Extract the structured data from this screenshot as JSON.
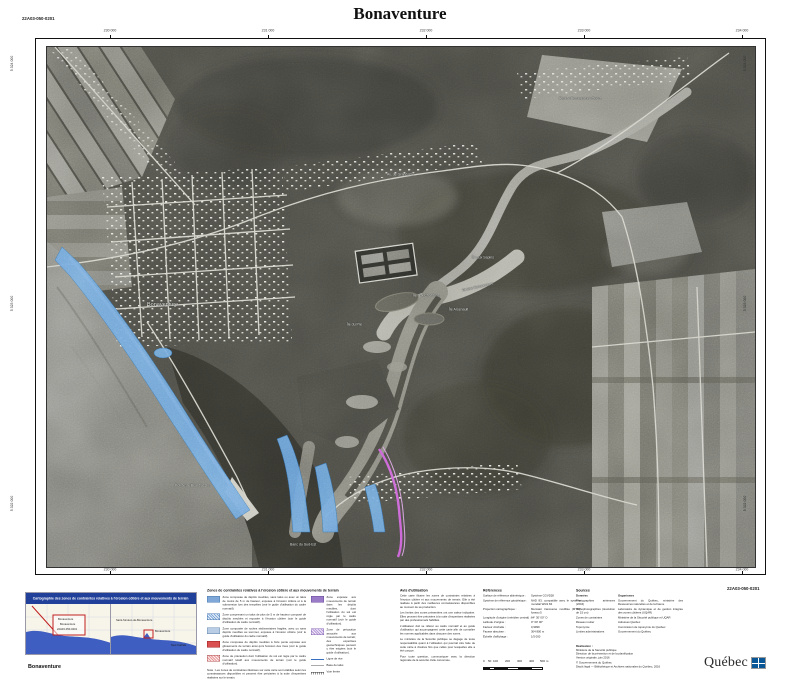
{
  "header": {
    "title": "Bonaventure",
    "sheet_code": "22A03-050-0201"
  },
  "footer": {
    "sheet_code": "22A03-050-0201",
    "map_name": "Bonaventure"
  },
  "map": {
    "grid": {
      "top": [
        "230 000",
        "231 000",
        "232 000",
        "233 000",
        "234 000"
      ],
      "bottom": [
        "230 000",
        "231 000",
        "232 000",
        "233 000",
        "234 000"
      ],
      "left": [
        "5 324 000",
        "5 323 000",
        "5 322 000"
      ],
      "right": [
        "5 324 000",
        "5 323 000",
        "5 322 000"
      ]
    },
    "labels": [
      {
        "text": "Bonaventure"
      },
      {
        "text": "Pointe de Beaubassin"
      },
      {
        "text": "Rivière Bonaventure"
      },
      {
        "text": "Rivière Bonaventure Ouest"
      },
      {
        "text": "Île aux Chardons"
      },
      {
        "text": "Île Arsenault"
      },
      {
        "text": "Île aux Sapins"
      },
      {
        "text": "Île du Pré"
      },
      {
        "text": "Banc du Sud-Est"
      },
      {
        "text": "Av. de Grand-Pré"
      }
    ],
    "zone_colors": {
      "erosion_blue": "#6aa2dd",
      "mouvement_purple": "#c85ed4"
    }
  },
  "inset": {
    "title": "Cartographie des zones de contraintes relatives à l'érosion côtière et aux mouvements de terrain",
    "left_labels": [
      "Bonaventure",
      "Bonaventure",
      "22A03-050-0201"
    ],
    "right_labels": [
      "Saint-Siméon-de-Bonaventure",
      "Bonaventure",
      "New Carlisle"
    ]
  },
  "legend": {
    "title": "Zones de contraintes relatives à l'érosion côtière et aux mouvements de terrain",
    "items": [
      {
        "text": "Zone composée de dépôts meubles, sans talus ou avec un talus de moins de 5 m de hauteur, exposée à l'érosion côtière et à la submersion lors des tempêtes (voir le guide d'utilisation du cadre normatif)."
      },
      {
        "text": "Zone comprenant un talus de plus de 5 m de hauteur composé de dépôts meubles et exposée à l'érosion côtière (voir le guide d'utilisation du cadre normatif)."
      },
      {
        "text": "Zone composée de roches sédimentaires fragiles, avec ou sans dépôts meubles au sommet, exposée à l'érosion côtière (voir le guide d'utilisation du cadre normatif)."
      },
      {
        "text": "Zone composée de dépôts meubles à forte pente exposée aux glissements de terrain ainsi qu'à l'érosion des rives (voir le guide d'utilisation du cadre normatif)."
      },
      {
        "text": "Zone de précaution dont l'utilisation du sol est régie par le cadre normatif relatif aux mouvements de terrain (voir le guide d'utilisation)."
      }
    ],
    "items_right": [
      {
        "text": "Zone exposée aux mouvements de terrain dans les dépôts meubles, dont l'utilisation du sol est régie par le cadre normatif (voir le guide d'utilisation)."
      },
      {
        "text": "Zone de précaution associée aux mouvements de terrain; des expertises géotechniques peuvent y être exigées (voir le guide d'utilisation)."
      }
    ],
    "symbols": [
      {
        "name": "Ligne de rive"
      },
      {
        "name": "Base de talus"
      },
      {
        "name": "Voie ferrée"
      }
    ],
    "nota": "Nota : Les zones de contraintes illustrées sur cette carte sont établies selon les connaissances disponibles et peuvent être précisées à la suite d'expertises réalisées sur le terrain."
  },
  "avis": {
    "title": "Avis d'utilisation",
    "paragraphs": [
      "Cette carte illustre les zones de contraintes relatives à l'érosion côtière et aux mouvements de terrain. Elle a été réalisée à partir des meilleures connaissances disponibles au moment de sa production.",
      "Les limites des zones présentées ont une valeur indicative. Elles peuvent être précisées à la suite d'expertises réalisées par des professionnels habilités.",
      "L'utilisateur doit se référer au cadre normatif et au guide d'utilisation qui accompagnent cette carte afin de connaître les normes applicables dans chacune des zones.",
      "Le ministère de la Sécurité publique se dégage de toute responsabilité quant à l'utilisation qui pourrait être faite de cette carte à d'autres fins que celles pour lesquelles elle a été conçue.",
      "Pour toute question, communiquer avec la direction régionale de la sécurité civile concernée."
    ]
  },
  "references": {
    "title": "Références",
    "rows": [
      {
        "label": "Surface de référence altimétrique :",
        "value": "Système CGVD28"
      },
      {
        "label": "Système de référence géodésique :",
        "value": "NAD 83, compatible avec le système mondial WGS 84"
      },
      {
        "label": "Projection cartographique :",
        "value": "Mercator transverse modifiée (MTM), fuseau 5"
      },
      {
        "label": "Longitude d'origine (méridien central) :",
        "value": "64° 30′ 00″ O"
      },
      {
        "label": "Latitude d'origine :",
        "value": "0° 00′ 00″"
      },
      {
        "label": "Facteur d'échelle :",
        "value": "0,9999"
      },
      {
        "label": "Fausse abscisse :",
        "value": "304 800 m"
      },
      {
        "label": "Échelle d'affichage :",
        "value": "1/5 000"
      }
    ]
  },
  "scalebar": {
    "labels": [
      "0",
      "50",
      "100",
      "200",
      "300",
      "400",
      "500 m"
    ]
  },
  "sources": {
    "title": "Sources",
    "header": {
      "data": "Données",
      "org": "Organismes"
    },
    "rows": [
      {
        "data": "Photographies aériennes (2004)",
        "org": "Gouvernement du Québec, ministère des Ressources naturelles et de la Faune"
      },
      {
        "data": "Orthophotographies (résolution de 15 cm)",
        "org": "Laboratoire de dynamique et de gestion intégrée des zones côtières (UQAR)"
      },
      {
        "data": "Zones de contraintes",
        "org": "Ministère de la Sécurité publique et UQAR"
      },
      {
        "data": "Réseau routier",
        "org": "Adresses Québec"
      },
      {
        "data": "Toponymie",
        "org": "Commission de toponymie du Québec"
      },
      {
        "data": "Limites administratives",
        "org": "Gouvernement du Québec"
      }
    ]
  },
  "realisation": {
    "title": "Réalisation :",
    "lines": [
      "Ministère de la Sécurité publique",
      "Direction de la prévention et de la planification",
      "Version originale, juin 2016"
    ],
    "copyright": "© Gouvernement du Québec",
    "depot": "Dépôt légal — Bibliothèque et Archives nationales du Québec, 2016"
  },
  "logo": {
    "text": "Québec"
  }
}
